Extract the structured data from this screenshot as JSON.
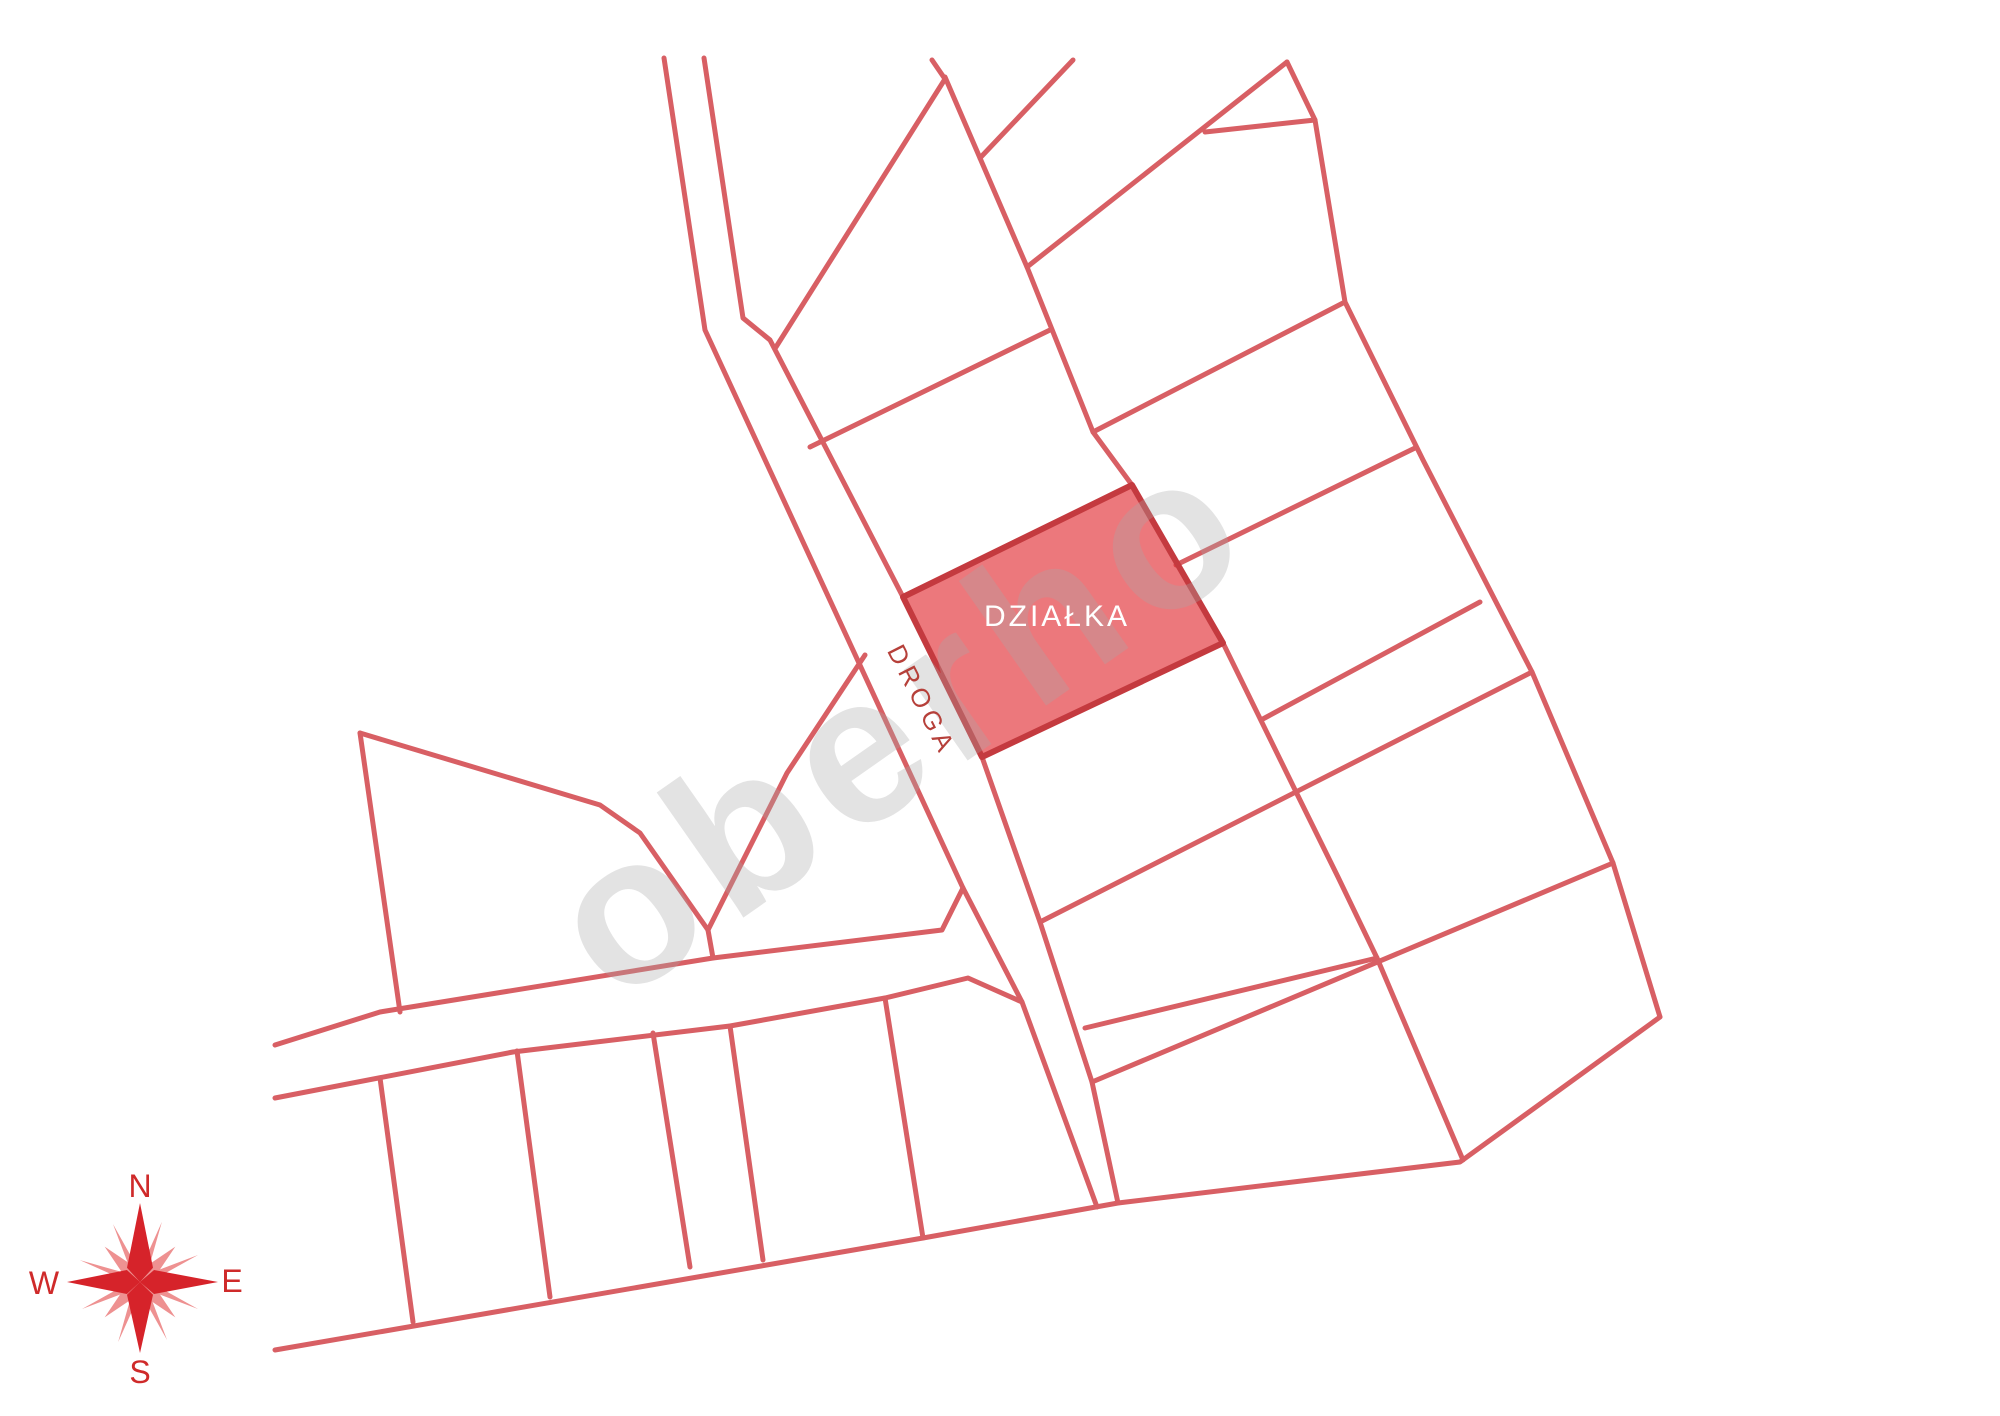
{
  "map": {
    "stroke_width": 5,
    "colors": {
      "line": "#d85f64",
      "plot_fill": "rgba(226,50,56,0.66)",
      "plot_stroke": "#c43a3f",
      "compass_main": "#d6232a",
      "compass_light": "#ee9191",
      "compass_text": "#cf2a2a",
      "watermark": "rgba(168,168,168,0.32)"
    },
    "plot": {
      "points": "903,597 1132,485 1223,643 982,757",
      "label": {
        "text": "DZIAŁKA",
        "x": 1057,
        "y": 617,
        "rotate": 0,
        "size": 30
      }
    },
    "road": {
      "label": {
        "text": "DROGA",
        "x": 922,
        "y": 700,
        "rotate": 63,
        "size": 26
      }
    },
    "watermark": {
      "text": "oberho",
      "x": 900,
      "y": 720,
      "rotate": -35,
      "size": 210
    },
    "compass": {
      "x": 140,
      "y": 1282,
      "labels": {
        "n": {
          "text": "N",
          "x": 140,
          "y": 1186,
          "rotate": 0,
          "size": 32
        },
        "e": {
          "text": "E",
          "x": 232,
          "y": 1281,
          "rotate": 0,
          "size": 32
        },
        "s": {
          "text": "S",
          "x": 140,
          "y": 1372,
          "rotate": 0,
          "size": 32
        },
        "w": {
          "text": "W",
          "x": 44,
          "y": 1283,
          "rotate": 0,
          "size": 32
        }
      }
    },
    "lines": [
      {
        "name": "road-west-line",
        "points": "664,58 705,330 963,888 1022,1002 1097,1207"
      },
      {
        "name": "road-east-line",
        "points": "704,58 743,318 770,340 903,597 982,757 1040,922 1092,1082 1118,1203"
      },
      {
        "name": "wedge-hypotenuse",
        "points": "932,60 945,79 776,347"
      },
      {
        "name": "column-west-boundary",
        "points": "945,77 1027,267 1093,432 1132,485"
      },
      {
        "name": "north-stub",
        "points": "980,158 1073,60"
      },
      {
        "name": "northeast-diagonal",
        "points": "1027,267 1287,62"
      },
      {
        "name": "east-zigzag-boundary",
        "points": "1287,62 1315,120 1345,302 1423,460 1532,672 1613,863 1660,1017"
      },
      {
        "name": "parcel-divider-ne-1",
        "points": "1205,132 1315,120"
      },
      {
        "name": "parcel-divider-ne-2",
        "points": "1343,303 1093,432"
      },
      {
        "name": "parcel-divider-ne-3",
        "points": "1415,448 1176,565"
      },
      {
        "name": "parcel-divider-ne-4",
        "points": "1480,602 1261,720"
      },
      {
        "name": "column-east-of-plot",
        "points": "1223,643 1300,800 1338,877 1377,958 1463,1160"
      },
      {
        "name": "parcel-divider-e-1",
        "points": "1040,922 1532,672"
      },
      {
        "name": "parcel-divider-e-2",
        "points": "1085,1028 1377,958"
      },
      {
        "name": "parcel-divider-e-3",
        "points": "1092,1082 1613,863"
      },
      {
        "name": "south-boundary",
        "points": "275,1350 923,1238 1118,1203 1460,1162 1660,1017"
      },
      {
        "name": "cross-road-north-line",
        "points": "275,1045 380,1012 713,958 942,930 963,888"
      },
      {
        "name": "cross-road-south-line",
        "points": "275,1098 513,1052 730,1026 885,998 968,978 1022,1002"
      },
      {
        "name": "parcel-divider-nw",
        "points": "810,447 1050,330"
      },
      {
        "name": "pentagon-west-edge",
        "points": "360,733 400,1012"
      },
      {
        "name": "pentagon-north-edge",
        "points": "360,733 600,805 640,833 708,930"
      },
      {
        "name": "pentagon-stem",
        "points": "708,930 713,958"
      },
      {
        "name": "sliver-divider",
        "points": "865,655 787,773 708,930"
      },
      {
        "name": "divider-sw-1",
        "points": "380,1078 413,1322"
      },
      {
        "name": "divider-sw-2",
        "points": "517,1051 550,1297"
      },
      {
        "name": "divider-sw-3",
        "points": "653,1033 690,1267"
      },
      {
        "name": "divider-sw-4",
        "points": "730,1026 763,1260"
      },
      {
        "name": "divider-sw-5",
        "points": "885,998 923,1238"
      }
    ]
  }
}
